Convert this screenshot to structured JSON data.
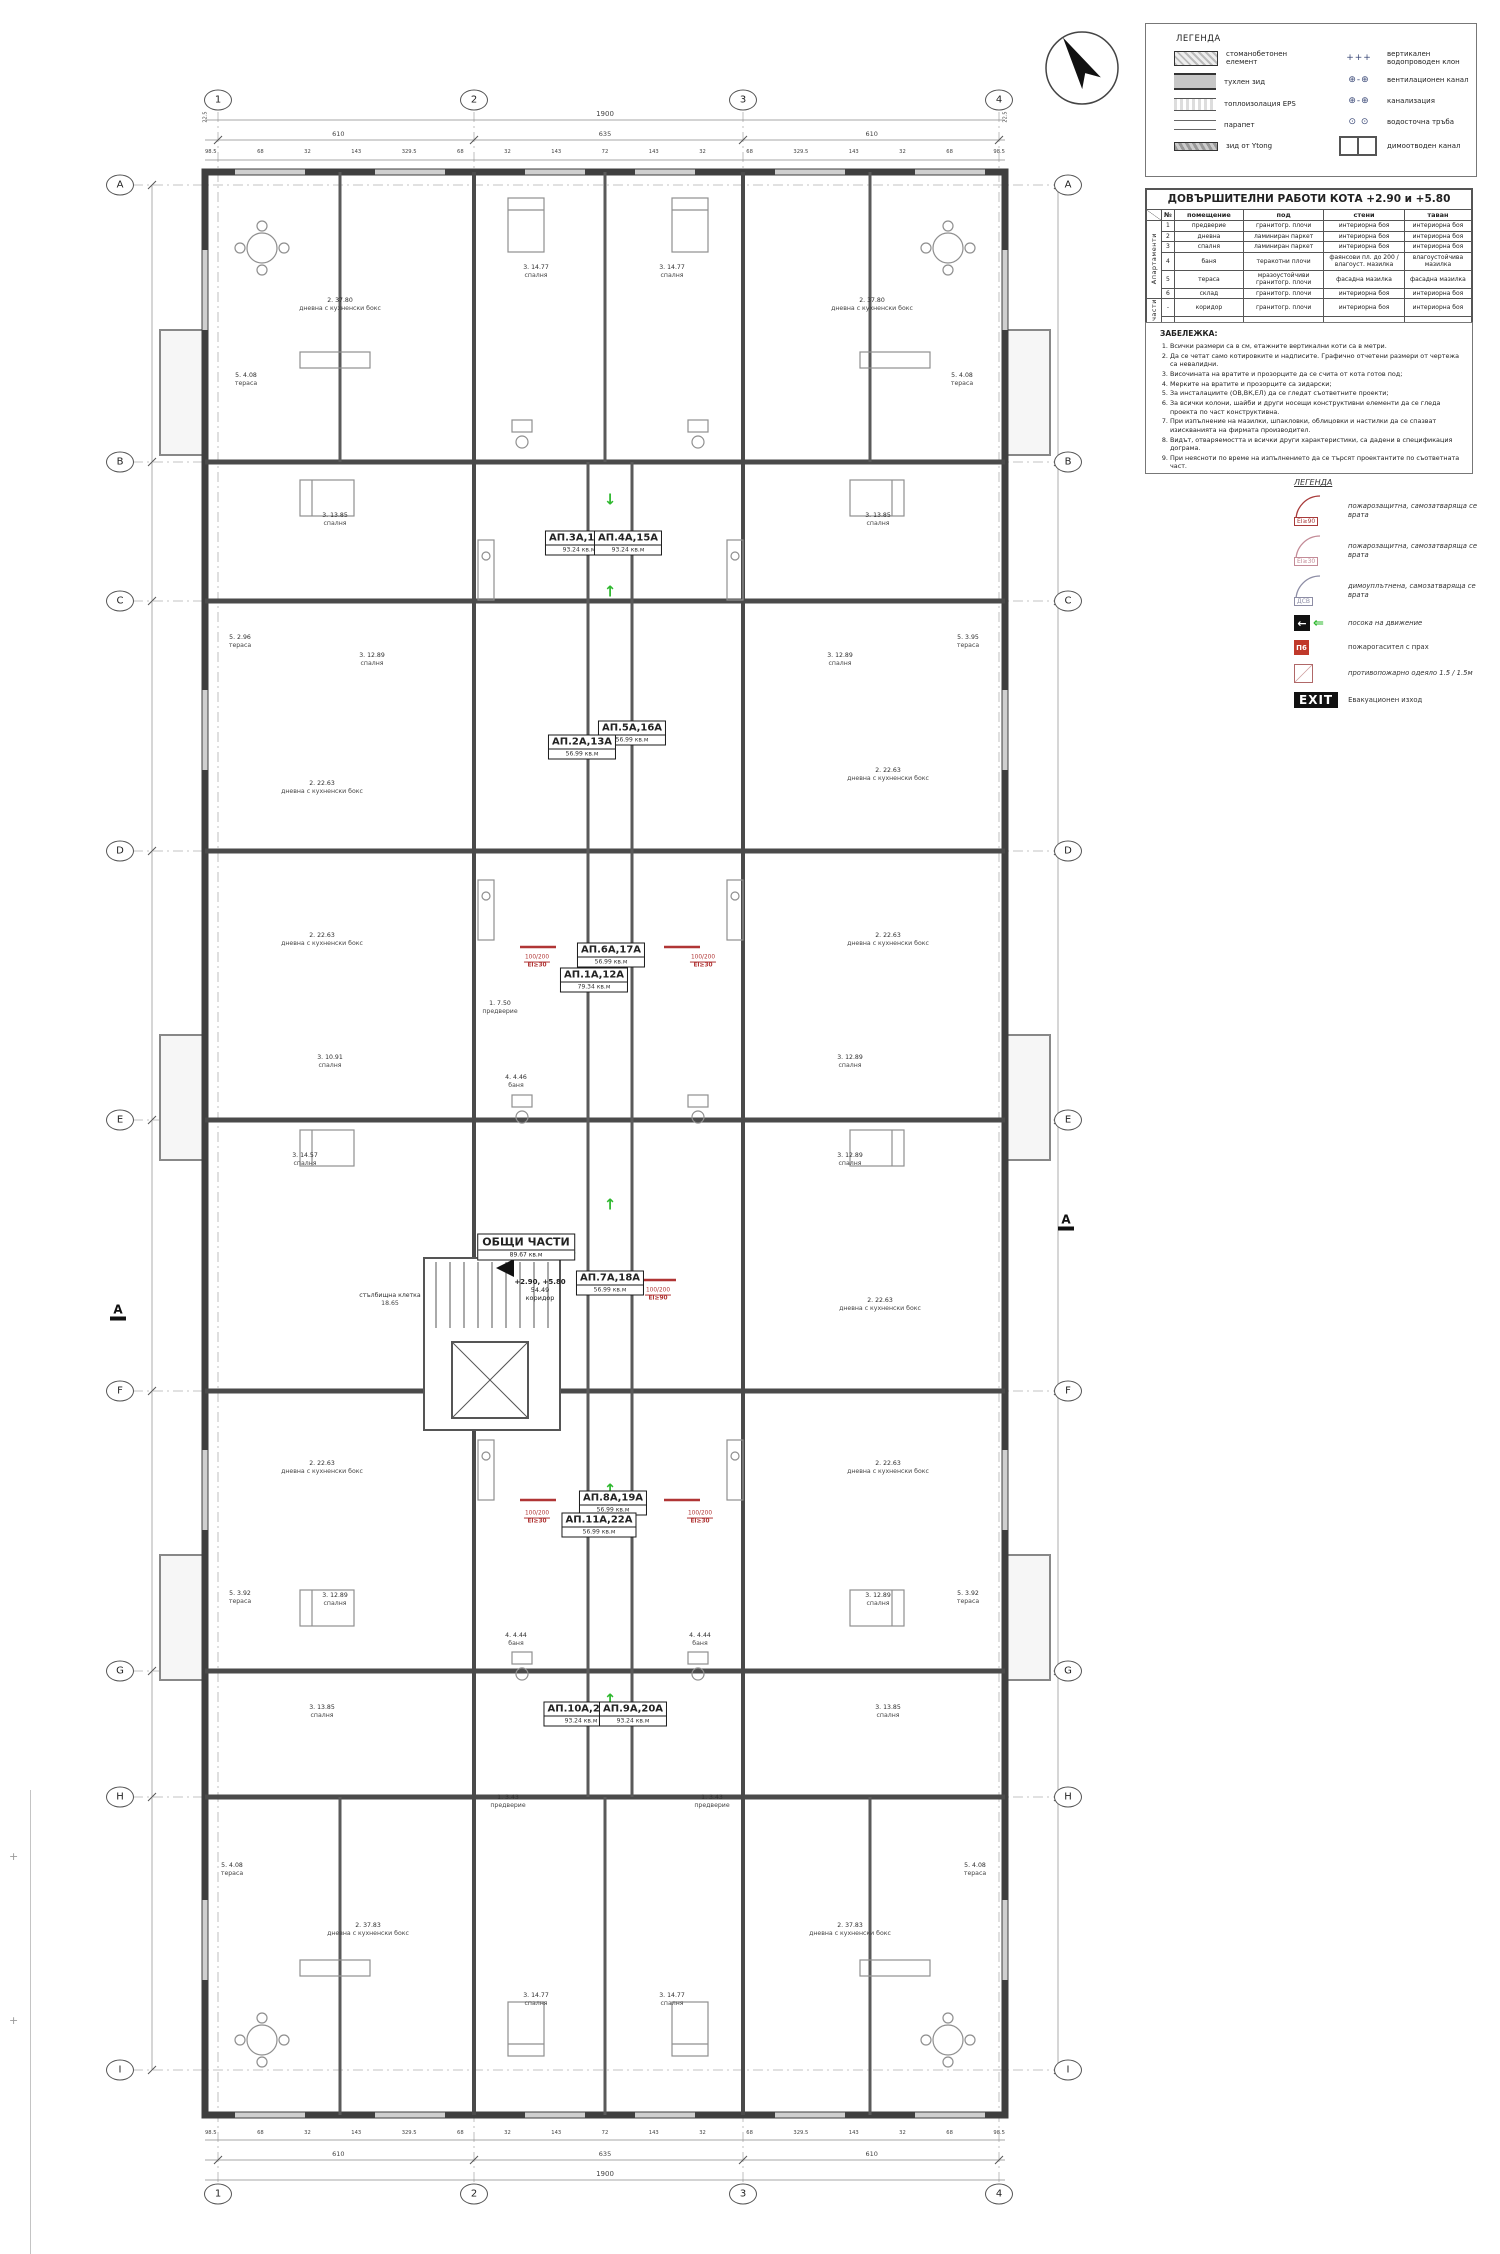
{
  "grid": {
    "columns": [
      {
        "label": "1",
        "x": 218
      },
      {
        "label": "2",
        "x": 474
      },
      {
        "label": "3",
        "x": 743
      },
      {
        "label": "4",
        "x": 999
      }
    ],
    "rows": [
      {
        "label": "A",
        "y": 185
      },
      {
        "label": "B",
        "y": 462
      },
      {
        "label": "C",
        "y": 601
      },
      {
        "label": "D",
        "y": 851
      },
      {
        "label": "E",
        "y": 1120
      },
      {
        "label": "F",
        "y": 1391
      },
      {
        "label": "G",
        "y": 1671
      },
      {
        "label": "H",
        "y": 1797
      },
      {
        "label": "I",
        "y": 2070
      }
    ]
  },
  "dims": {
    "total": "1900",
    "edge_left": "22.5",
    "edge_right": "22.5",
    "mids": [
      "610",
      "635",
      "610"
    ],
    "chain": [
      "98.5",
      "68",
      "32",
      "143",
      "329.5",
      "68",
      "32",
      "143",
      "72",
      "143",
      "32",
      "68",
      "329.5",
      "143",
      "32",
      "68",
      "98.5"
    ]
  },
  "section_markers": [
    {
      "label": "A",
      "x": 118,
      "y": 1312
    },
    {
      "label": "A",
      "x": 1066,
      "y": 1222
    }
  ],
  "apartments": [
    {
      "name": "АП.3А,14А",
      "area": "93.24",
      "unit": "кв.м",
      "x": 579,
      "y": 543
    },
    {
      "name": "АП.4А,15А",
      "area": "93.24",
      "unit": "кв.м",
      "x": 628,
      "y": 543
    },
    {
      "name": "АП.5А,16А",
      "area": "56.99",
      "unit": "кв.м",
      "x": 632,
      "y": 733
    },
    {
      "name": "АП.2А,13А",
      "area": "56.99",
      "unit": "кв.м",
      "x": 582,
      "y": 747
    },
    {
      "name": "АП.6А,17А",
      "area": "56.99",
      "unit": "кв.м",
      "x": 611,
      "y": 955
    },
    {
      "name": "АП.1А,12А",
      "area": "79.34",
      "unit": "кв.м",
      "x": 594,
      "y": 980
    },
    {
      "name": "АП.7А,18А",
      "area": "56.99",
      "unit": "кв.м",
      "x": 610,
      "y": 1283
    },
    {
      "name": "АП.8А,19А",
      "area": "56.99",
      "unit": "кв.м",
      "x": 613,
      "y": 1503
    },
    {
      "name": "АП.11А,22А",
      "area": "56.99",
      "unit": "кв.м",
      "x": 599,
      "y": 1525
    },
    {
      "name": "АП.10А,21А",
      "area": "93.24",
      "unit": "кв.м",
      "x": 581,
      "y": 1714
    },
    {
      "name": "АП.9А,20А",
      "area": "93.24",
      "unit": "кв.м",
      "x": 633,
      "y": 1714
    }
  ],
  "common": {
    "name": "ОБЩИ ЧАСТИ",
    "area": "89.67",
    "unit": "кв.м",
    "levels": "+2.90, +5.80",
    "extra": "54.49",
    "extra_label": "коридор"
  },
  "room_labels": [
    {
      "l1": "2. 37.80",
      "l2": "дневна с кухненски бокс",
      "x": 340,
      "y": 305
    },
    {
      "l1": "2. 37.80",
      "l2": "дневна с кухненски бокс",
      "x": 872,
      "y": 305
    },
    {
      "l1": "3. 14.77",
      "l2": "спалня",
      "x": 536,
      "y": 272
    },
    {
      "l1": "3. 14.77",
      "l2": "спалня",
      "x": 672,
      "y": 272
    },
    {
      "l1": "5. 4.08",
      "l2": "тераса",
      "x": 246,
      "y": 380
    },
    {
      "l1": "5. 4.08",
      "l2": "тераса",
      "x": 962,
      "y": 380
    },
    {
      "l1": "3. 13.85",
      "l2": "спалня",
      "x": 335,
      "y": 520
    },
    {
      "l1": "3. 13.85",
      "l2": "спалня",
      "x": 878,
      "y": 520
    },
    {
      "l1": "5. 2.96",
      "l2": "тераса",
      "x": 240,
      "y": 642
    },
    {
      "l1": "5. 3.95",
      "l2": "тераса",
      "x": 968,
      "y": 642
    },
    {
      "l1": "3. 12.89",
      "l2": "спалня",
      "x": 372,
      "y": 660
    },
    {
      "l1": "3. 12.89",
      "l2": "спалня",
      "x": 840,
      "y": 660
    },
    {
      "l1": "2. 22.63",
      "l2": "дневна с кухненски бокс",
      "x": 322,
      "y": 788
    },
    {
      "l1": "2. 22.63",
      "l2": "дневна с кухненски бокс",
      "x": 888,
      "y": 775
    },
    {
      "l1": "2. 22.63",
      "l2": "дневна с кухненски бокс",
      "x": 322,
      "y": 940
    },
    {
      "l1": "2. 22.63",
      "l2": "дневна с кухненски бокс",
      "x": 888,
      "y": 940
    },
    {
      "l1": "1. 7.50",
      "l2": "предверие",
      "x": 500,
      "y": 1008
    },
    {
      "l1": "3. 10.91",
      "l2": "спалня",
      "x": 330,
      "y": 1062
    },
    {
      "l1": "3. 12.89",
      "l2": "спалня",
      "x": 850,
      "y": 1062
    },
    {
      "l1": "4. 4.46",
      "l2": "баня",
      "x": 516,
      "y": 1082
    },
    {
      "l1": "3. 14.57",
      "l2": "спалня",
      "x": 305,
      "y": 1160
    },
    {
      "l1": "3. 12.89",
      "l2": "спалня",
      "x": 850,
      "y": 1160
    },
    {
      "l1": "стълбищна клетка",
      "l2": "18.65",
      "x": 390,
      "y": 1300
    },
    {
      "l1": "2. 22.63",
      "l2": "дневна с кухненски бокс",
      "x": 880,
      "y": 1305
    },
    {
      "l1": "2. 22.63",
      "l2": "дневна с кухненски бокс",
      "x": 322,
      "y": 1468
    },
    {
      "l1": "2. 22.63",
      "l2": "дневна с кухненски бокс",
      "x": 888,
      "y": 1468
    },
    {
      "l1": "5. 3.92",
      "l2": "тераса",
      "x": 240,
      "y": 1598
    },
    {
      "l1": "5. 3.92",
      "l2": "тераса",
      "x": 968,
      "y": 1598
    },
    {
      "l1": "3. 12.89",
      "l2": "спалня",
      "x": 335,
      "y": 1600
    },
    {
      "l1": "3. 12.89",
      "l2": "спалня",
      "x": 878,
      "y": 1600
    },
    {
      "l1": "4. 4.44",
      "l2": "баня",
      "x": 516,
      "y": 1640
    },
    {
      "l1": "4. 4.44",
      "l2": "баня",
      "x": 700,
      "y": 1640
    },
    {
      "l1": "3. 13.85",
      "l2": "спалня",
      "x": 322,
      "y": 1712
    },
    {
      "l1": "3. 13.85",
      "l2": "спалня",
      "x": 888,
      "y": 1712
    },
    {
      "l1": "1. 3.43",
      "l2": "предверие",
      "x": 508,
      "y": 1802
    },
    {
      "l1": "1. 3.43",
      "l2": "предверие",
      "x": 712,
      "y": 1802
    },
    {
      "l1": "2. 37.83",
      "l2": "дневна с кухненски бокс",
      "x": 368,
      "y": 1930
    },
    {
      "l1": "2. 37.83",
      "l2": "дневна с кухненски бокс",
      "x": 850,
      "y": 1930
    },
    {
      "l1": "3. 14.77",
      "l2": "спалня",
      "x": 536,
      "y": 2000
    },
    {
      "l1": "3. 14.77",
      "l2": "спалня",
      "x": 672,
      "y": 2000
    },
    {
      "l1": "5. 4.08",
      "l2": "тераса",
      "x": 232,
      "y": 1870
    },
    {
      "l1": "5. 4.08",
      "l2": "тераса",
      "x": 975,
      "y": 1870
    }
  ],
  "fire_labels": [
    {
      "size": "100/200",
      "rating": "EI≥30",
      "x": 537,
      "y": 962
    },
    {
      "size": "100/200",
      "rating": "EI≥30",
      "x": 703,
      "y": 962
    },
    {
      "size": "100/200",
      "rating": "EI≥90",
      "x": 658,
      "y": 1295
    },
    {
      "size": "100/200",
      "rating": "EI≥30",
      "x": 537,
      "y": 1518
    },
    {
      "size": "100/200",
      "rating": "EI≥30",
      "x": 700,
      "y": 1518
    }
  ],
  "arrows": [
    {
      "dir": "down",
      "x": 610,
      "y": 500
    },
    {
      "dir": "up",
      "x": 610,
      "y": 592
    },
    {
      "dir": "up",
      "x": 610,
      "y": 737
    },
    {
      "dir": "up",
      "x": 610,
      "y": 952
    },
    {
      "dir": "up",
      "x": 610,
      "y": 1205
    },
    {
      "dir": "left",
      "x": 570,
      "y": 1253
    },
    {
      "dir": "up",
      "x": 610,
      "y": 1490
    },
    {
      "dir": "up",
      "x": 610,
      "y": 1700
    }
  ],
  "legend1": {
    "title": "ЛЕГЕНДА",
    "left": [
      {
        "icon": "concrete-swatch",
        "label": "стоманобетонен елемент"
      },
      {
        "icon": "brick-swatch",
        "label": "тухлен зид"
      },
      {
        "icon": "eps-swatch",
        "label": "топлоизолация EPS"
      },
      {
        "icon": "parapet-swatch",
        "label": "парапет"
      },
      {
        "icon": "ytong-swatch",
        "label": "зид от Ytong"
      }
    ],
    "right": [
      {
        "icon": "riser-symbol",
        "glyph": "+++",
        "label": "вертикален водопроводен клон"
      },
      {
        "icon": "vent-symbol",
        "glyph": "⊕-⊕",
        "label": "вентилационен канал"
      },
      {
        "icon": "sewer-symbol",
        "glyph": "⊕-⊕",
        "label": "канализация"
      },
      {
        "icon": "downpipe-symbol",
        "glyph": "⊙ ⊙",
        "label": "водосточна тръба"
      },
      {
        "icon": "smoke-duct-symbol",
        "glyph": "",
        "label": "димоотводен канал"
      }
    ]
  },
  "works_table": {
    "title": "ДОВЪРШИТЕЛНИ РАБОТИ КОТА +2.90 и +5.80",
    "headers": [
      "№",
      "помещение",
      "под",
      "стени",
      "таван"
    ],
    "groups": [
      {
        "label": "Апартаменти",
        "rows": [
          [
            "1",
            "предверие",
            "гранитогр. плочи",
            "интериорна боя",
            "интериорна боя"
          ],
          [
            "2",
            "дневна",
            "ламиниран паркет",
            "интериорна боя",
            "интериорна боя"
          ],
          [
            "3",
            "спалня",
            "ламиниран паркет",
            "интериорна боя",
            "интериорна боя"
          ],
          [
            "4",
            "баня",
            "теракотни плочи",
            "фаянсови пл. до 200 / влагоуст. мазилка",
            "влагоустойчива мазилка"
          ],
          [
            "5",
            "тераса",
            "мразоустойчиви гранитогр. плочи",
            "фасадна мазилка",
            "фасадна мазилка"
          ],
          [
            "6",
            "склад",
            "гранитогр. плочи",
            "интериорна боя",
            "интериорна боя"
          ]
        ]
      },
      {
        "label": "Общи части",
        "rows": [
          [
            "-",
            "коридор",
            "гранитогр. плочи",
            "интериорна боя",
            "интериорна боя"
          ],
          [
            "-",
            "стълбищна клетка с коридор",
            "гранитогр. плочи",
            "интериорна боя",
            "интериорна боя"
          ]
        ]
      }
    ]
  },
  "notes": {
    "title": "ЗАБЕЛЕЖКА:",
    "items": [
      "Всички размери са в см, етажните вертикални коти са в метри.",
      "Да се четат само котировките и надписите. Графично отчетени размери от чертежа са невалидни.",
      "Височината на вратите и прозорците да се счита от кота готов под;",
      "Мерките на вратите и прозорците са зидарски;",
      "За инсталациите (ОВ,ВК,ЕЛ) да се гледат съответните проекти;",
      "За всички колони, шайби и други носещи конструктивни елементи да се гледа проекта по част конструктивна.",
      "При изпълнение на мазилки, шпакловки, облицовки и настилки да се спазват изискванията на фирмата производител.",
      "Видът, отваряемостта и всички други характеристики, са дадени в спецификация дограма.",
      "При неясноти по време на изпълнението да се търсят проектантите по съответната част."
    ]
  },
  "legend2": {
    "title": "ЛЕГЕНДА",
    "items": [
      {
        "symbol": "EI≥90",
        "label": "пожарозащитна, самозатваряща се врата"
      },
      {
        "symbol": "EI≥30",
        "label": "пожарозащитна, самозатваряща се врата"
      },
      {
        "symbol": "ДСВ",
        "label": "димоуплътнена, самозатваряща се врата"
      },
      {
        "symbol": "",
        "label": "посока на движение"
      },
      {
        "symbol": "П6",
        "label": "пожарогасител с прах"
      },
      {
        "symbol": "",
        "label": "противопожарно одеяло 1.5 / 1.5м"
      },
      {
        "symbol": "EXIT",
        "label": "Евакуационен изход"
      }
    ]
  },
  "colors": {
    "wall": "#3f3f3f",
    "green_arrow": "#2eb82e",
    "fire_red": "#b03535",
    "ei90": "#a83a3a",
    "ei30": "#c38b97",
    "dsv": "#8d8da5"
  }
}
